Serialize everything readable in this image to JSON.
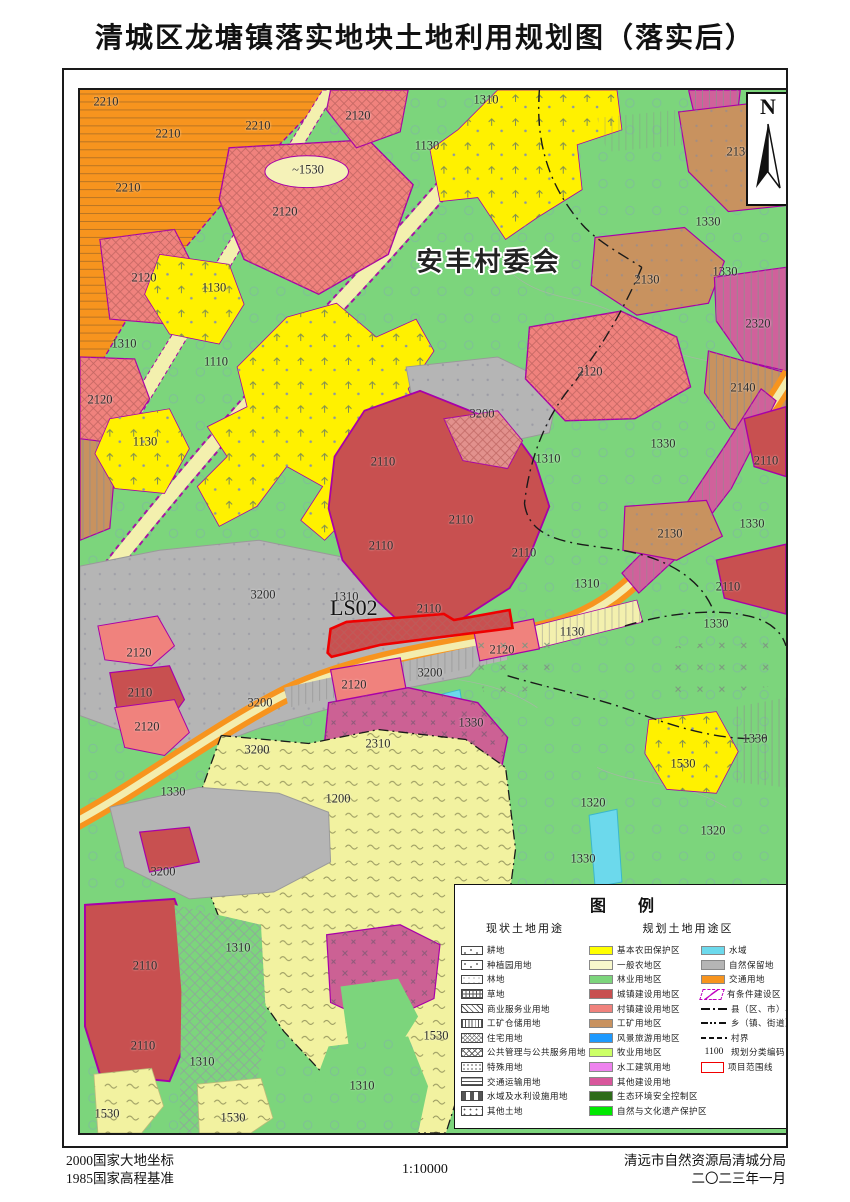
{
  "title": "清城区龙塘镇落实地块土地利用规划图（落实后）",
  "map": {
    "village_committee_label": "安丰村委会",
    "parcel_code": "LS02",
    "north_label": "N",
    "labels": [
      {
        "t": "2210",
        "x": 26,
        "y": 12
      },
      {
        "t": "2210",
        "x": 88,
        "y": 44
      },
      {
        "t": "2210",
        "x": 178,
        "y": 36
      },
      {
        "t": "2210",
        "x": 48,
        "y": 98
      },
      {
        "t": "~1530",
        "x": 228,
        "y": 80
      },
      {
        "t": "2120",
        "x": 278,
        "y": 26
      },
      {
        "t": "2120",
        "x": 205,
        "y": 122
      },
      {
        "t": "2120",
        "x": 64,
        "y": 188
      },
      {
        "t": "2120",
        "x": 20,
        "y": 310
      },
      {
        "t": "2120",
        "x": 510,
        "y": 282
      },
      {
        "t": "2120",
        "x": 59,
        "y": 563
      },
      {
        "t": "2120",
        "x": 67,
        "y": 637
      },
      {
        "t": "2120",
        "x": 422,
        "y": 560
      },
      {
        "t": "2120",
        "x": 274,
        "y": 595
      },
      {
        "t": "1130",
        "x": 134,
        "y": 198
      },
      {
        "t": "1130",
        "x": 347,
        "y": 56
      },
      {
        "t": "1130",
        "x": 65,
        "y": 352
      },
      {
        "t": "1130",
        "x": 492,
        "y": 542
      },
      {
        "t": "1110",
        "x": 136,
        "y": 272
      },
      {
        "t": "1310",
        "x": 406,
        "y": 10
      },
      {
        "t": "1310",
        "x": 44,
        "y": 254
      },
      {
        "t": "1310",
        "x": 266,
        "y": 507
      },
      {
        "t": "1310",
        "x": 468,
        "y": 369
      },
      {
        "t": "1310",
        "x": 507,
        "y": 494
      },
      {
        "t": "1310",
        "x": 122,
        "y": 972
      },
      {
        "t": "1310",
        "x": 282,
        "y": 996
      },
      {
        "t": "1310",
        "x": 158,
        "y": 858
      },
      {
        "t": "1330",
        "x": 628,
        "y": 132
      },
      {
        "t": "1330",
        "x": 645,
        "y": 182
      },
      {
        "t": "1330",
        "x": 583,
        "y": 354
      },
      {
        "t": "1330",
        "x": 672,
        "y": 434
      },
      {
        "t": "1330",
        "x": 93,
        "y": 702
      },
      {
        "t": "1330",
        "x": 391,
        "y": 633
      },
      {
        "t": "1330",
        "x": 675,
        "y": 649
      },
      {
        "t": "1330",
        "x": 503,
        "y": 769
      },
      {
        "t": "1330",
        "x": 636,
        "y": 534
      },
      {
        "t": "2130",
        "x": 659,
        "y": 62
      },
      {
        "t": "2130",
        "x": 567,
        "y": 190
      },
      {
        "t": "2130",
        "x": 590,
        "y": 444
      },
      {
        "t": "2320",
        "x": 678,
        "y": 234
      },
      {
        "t": "2140",
        "x": 663,
        "y": 298
      },
      {
        "t": "2110",
        "x": 303,
        "y": 372
      },
      {
        "t": "2110",
        "x": 381,
        "y": 430
      },
      {
        "t": "2110",
        "x": 301,
        "y": 456
      },
      {
        "t": "2110",
        "x": 444,
        "y": 463
      },
      {
        "t": "2110",
        "x": 349,
        "y": 519
      },
      {
        "t": "2110",
        "x": 686,
        "y": 371
      },
      {
        "t": "2110",
        "x": 648,
        "y": 497
      },
      {
        "t": "2110",
        "x": 60,
        "y": 603
      },
      {
        "t": "2110",
        "x": 65,
        "y": 876
      },
      {
        "t": "2110",
        "x": 63,
        "y": 956
      },
      {
        "t": "3200",
        "x": 402,
        "y": 324
      },
      {
        "t": "3200",
        "x": 183,
        "y": 505
      },
      {
        "t": "3200",
        "x": 350,
        "y": 583
      },
      {
        "t": "3200",
        "x": 180,
        "y": 613
      },
      {
        "t": "3200",
        "x": 177,
        "y": 660
      },
      {
        "t": "3200",
        "x": 83,
        "y": 782
      },
      {
        "t": "1530",
        "x": 603,
        "y": 674
      },
      {
        "t": "1530",
        "x": 356,
        "y": 946
      },
      {
        "t": "1530",
        "x": 27,
        "y": 1024
      },
      {
        "t": "1530",
        "x": 153,
        "y": 1028
      },
      {
        "t": "1200",
        "x": 258,
        "y": 709
      },
      {
        "t": "2310",
        "x": 298,
        "y": 654
      },
      {
        "t": "1320",
        "x": 513,
        "y": 713
      },
      {
        "t": "1320",
        "x": 633,
        "y": 741
      }
    ]
  },
  "legend": {
    "title": "图 例",
    "current_header": "现状土地用途",
    "planned_header": "规划土地用途区",
    "current_items": [
      {
        "label": "耕地",
        "pattern": "ticks"
      },
      {
        "label": "种植园用地",
        "pattern": "seedling"
      },
      {
        "label": "林地",
        "pattern": "sparse-dots"
      },
      {
        "label": "草地",
        "pattern": "grid"
      },
      {
        "label": "商业服务业用地",
        "pattern": "diag"
      },
      {
        "label": "工矿仓储用地",
        "pattern": "vlines"
      },
      {
        "label": "住宅用地",
        "pattern": "crosshatch"
      },
      {
        "label": "公共管理与公共服务用地",
        "pattern": "diamonds"
      },
      {
        "label": "特殊用地",
        "pattern": "dotgrid"
      },
      {
        "label": "交通运输用地",
        "pattern": "hlines"
      },
      {
        "label": "水域及水利设施用地",
        "pattern": "dashes"
      },
      {
        "label": "其他土地",
        "pattern": "dots"
      }
    ],
    "planned_items": [
      {
        "label": "基本农田保护区",
        "color": "#FFFF00"
      },
      {
        "label": "一般农地区",
        "color": "#F8F8CC"
      },
      {
        "label": "林业用地区",
        "color": "#7CD57C"
      },
      {
        "label": "城镇建设用地区",
        "color": "#C85050"
      },
      {
        "label": "村镇建设用地区",
        "color": "#F0827D"
      },
      {
        "label": "工矿用地区",
        "color": "#C8925F"
      },
      {
        "label": "风景旅游用地区",
        "color": "#1E9AFF"
      },
      {
        "label": "牧业用地区",
        "color": "#CCFF66"
      },
      {
        "label": "水工建筑用地",
        "color": "#EE82EE"
      },
      {
        "label": "其他建设用地",
        "color": "#D8569B"
      },
      {
        "label": "生态环境安全控制区",
        "color": "#2E6C1A"
      },
      {
        "label": "自然与文化遗产保护区",
        "color": "#00E800"
      }
    ],
    "misc_items": [
      {
        "label": "水域",
        "type": "swatch",
        "color": "#6CD9EC"
      },
      {
        "label": "自然保留地",
        "type": "swatch",
        "color": "#B5B5B5"
      },
      {
        "label": "交通用地",
        "type": "swatch",
        "color": "#F7941E"
      },
      {
        "label": "有条件建设区",
        "type": "conditional"
      },
      {
        "label": "县（区、市）界",
        "type": "county-line"
      },
      {
        "label": "乡（镇、街道）界",
        "type": "town-line"
      },
      {
        "label": "村界",
        "type": "village-line"
      },
      {
        "label": "规划分类编码",
        "type": "code",
        "code": "1100"
      },
      {
        "label": "项目范围线",
        "type": "project"
      }
    ]
  },
  "footer": {
    "datum_line1": "2000国家大地坐标",
    "datum_line2": "1985国家高程基准",
    "scale": "1:10000",
    "agency": "清远市自然资源局清城分局",
    "date": "二〇二三年一月"
  },
  "colors": {
    "forest_green": "#7CD57C",
    "farmland_yellow": "#FFF100",
    "general_agri": "#F2F2A0",
    "transport_orange": "#F7941E",
    "town_red": "#C85050",
    "village_pink": "#F0827D",
    "mining_tan": "#C8925F",
    "reserve_gray": "#B5B5B5",
    "water_cyan": "#6CD9EC",
    "other_magenta": "#CC6194",
    "boundary_magenta": "#A800A8",
    "project_red": "#EE0000"
  }
}
